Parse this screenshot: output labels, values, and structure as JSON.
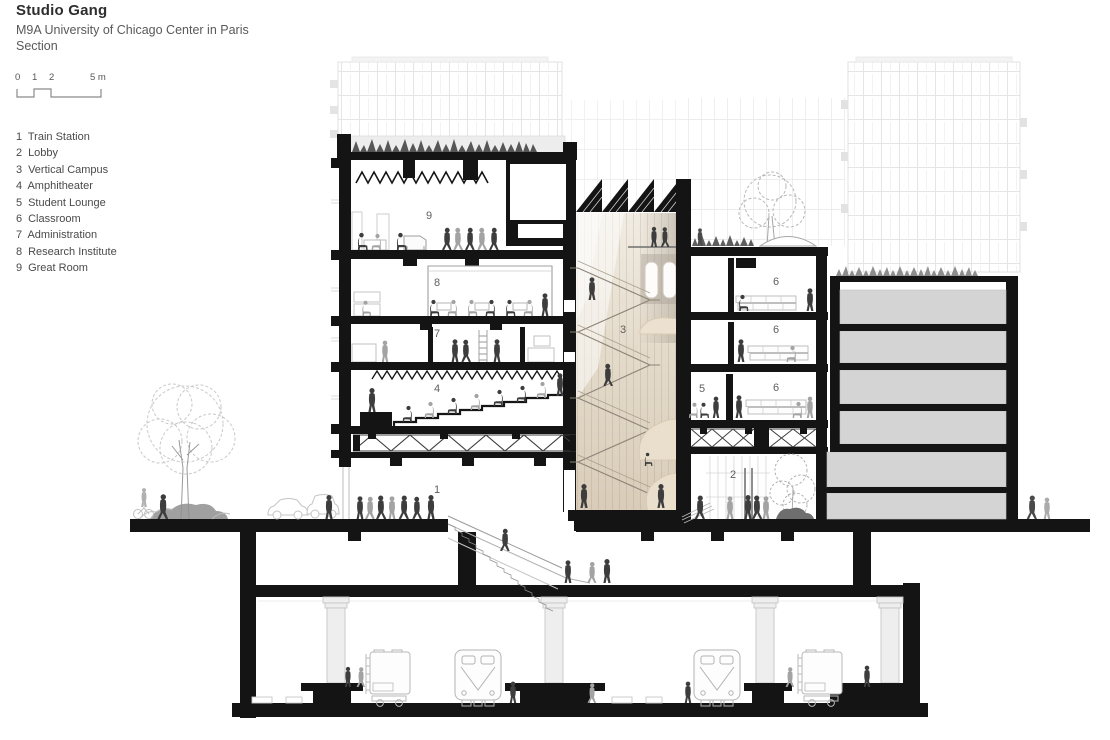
{
  "header": {
    "studio": "Studio Gang",
    "project": "M9A University of Chicago Center in Paris",
    "drawing_type": "Section"
  },
  "scale_bar": {
    "tick_0": "0",
    "tick_1": "1",
    "tick_2": "2",
    "tick_5": "5 m"
  },
  "legend": {
    "items": [
      {
        "num": "1",
        "label": "Train Station"
      },
      {
        "num": "2",
        "label": "Lobby"
      },
      {
        "num": "3",
        "label": "Vertical Campus"
      },
      {
        "num": "4",
        "label": "Amphitheater"
      },
      {
        "num": "5",
        "label": "Student Lounge"
      },
      {
        "num": "6",
        "label": "Classroom"
      },
      {
        "num": "7",
        "label": "Administration"
      },
      {
        "num": "8",
        "label": "Research Institute"
      },
      {
        "num": "9",
        "label": "Great Room"
      }
    ]
  },
  "rooms": {
    "r1": "1",
    "r2": "2",
    "r3": "3",
    "r4": "4",
    "r5": "5",
    "r6": "6",
    "r7": "7",
    "r8": "8",
    "r9": "9"
  },
  "colors": {
    "ink": "#141414",
    "people_dark": "#3d3d3d",
    "people_light": "#a3a3a3",
    "atrium_beige": "#e6dccb",
    "poche_gray": "#d4d4d4",
    "faint_line": "#e6e6e6",
    "plant_dark": "#565656"
  }
}
